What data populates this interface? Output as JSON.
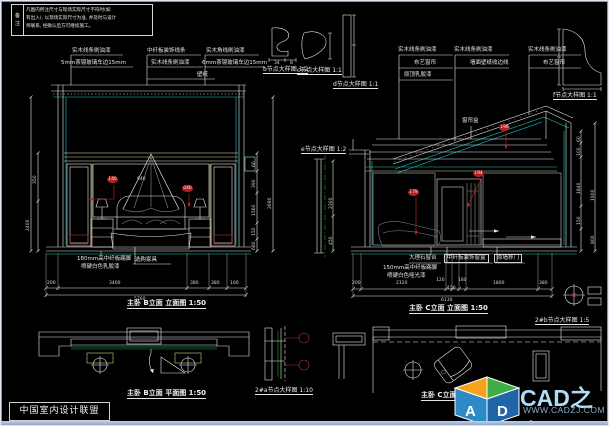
{
  "colors": {
    "background": "#000000",
    "line_white": "#e8e8e8",
    "line_cyan": "#18c8c8",
    "line_yellow": "#d8cc7a",
    "line_red": "#cc2a2a",
    "line_green": "#00b400",
    "logo_orange": "#f7a11c",
    "logo_green": "#3fae49",
    "logo_blue": "#2e7fc0",
    "brand_text": "#aedcf5"
  },
  "note": {
    "tab_chars": [
      "备",
      "注"
    ],
    "lines": [
      "凡图内所注尺寸与现场实际尺寸不符时(如",
      "有出入), 以现场实际尺寸为准, 并及时与设计",
      "师联系, 经确认后方可继续施工。"
    ]
  },
  "footer": {
    "union_label": "中国室内设计联盟"
  },
  "logo": {
    "brand": "CAD之家",
    "url": "WWW.CADZJ.COM",
    "letter_a": "A",
    "letter_d": "D"
  },
  "left_elevation": {
    "title": "主卧 B立面 立面图 1:50",
    "labels": {
      "a1": "实木线条刷油漆",
      "a2": "5mm茶镜玻璃车边15mm",
      "b1": "中纤板装饰线条",
      "b2": "实木线条刷油漆",
      "b3": "壁纸",
      "c1": "实木角线刷油漆",
      "c2": "6mm茶镜玻璃车边15mm",
      "skirting1": "180mm高中纤板踢脚",
      "skirting2": "喷硬白色乳胶漆",
      "furniture": "选购家具",
      "inner_dim": "940"
    },
    "markers": [
      "140",
      "040"
    ],
    "dims": {
      "bottom": [
        "200",
        "3400",
        "380",
        "380",
        "100"
      ],
      "bottom_total": "5760",
      "right": [
        "60",
        "390",
        "1560",
        "150",
        "680"
      ],
      "right_total": "2690",
      "left": [
        "350",
        "2400"
      ]
    }
  },
  "middle_details": {
    "b": {
      "title": "b节点大样图 1:2",
      "dims": [
        "34",
        "8"
      ]
    },
    "c": {
      "title": "c节点大样图 1:1"
    },
    "d": {
      "title": "d节点大样图 1:1"
    },
    "e": {
      "title": "e节点大样图 1:2",
      "dims": [
        "2300",
        "450"
      ]
    },
    "f": {
      "title": "f节点大样图 1:1"
    }
  },
  "right_elevation": {
    "title": "主卧 C立面 立面图 1:50",
    "labels": {
      "g1a": "实木线条刷油漆",
      "g1b": "布艺窗帘",
      "g1c": "原顶乳胶漆",
      "g2a": "实木线条刷油漆",
      "g2b": "墙面壁纸收边线",
      "g3a": "实木线条刷油漆",
      "g3b": "布艺窗帘",
      "curtain_box": "窗帘盒",
      "sill": "大理石窗台",
      "skirting1": "150mm高中纤板踢脚",
      "skirting2": "喷硬白色哑光漆",
      "window_trim": "中纤板装饰窗盒",
      "door": "原墙移门"
    },
    "markers": [
      "196",
      "194",
      "179"
    ],
    "dims": {
      "bottom": [
        "200",
        "2120",
        "120",
        "150",
        "180",
        "1800",
        "380"
      ],
      "bottom_total": "6130",
      "right": [
        "60",
        "100",
        "1840",
        "150",
        "1900",
        "800"
      ]
    }
  },
  "plans": {
    "left": {
      "title": "主卧 B立面 平面图 1:50"
    },
    "right": {
      "title": "主卧 C立面 平面图 1:50"
    },
    "detail_a": {
      "title": "2#a节点大样图 1:10"
    },
    "detail_b": {
      "title": "2#b节点大样图 1:5"
    }
  }
}
